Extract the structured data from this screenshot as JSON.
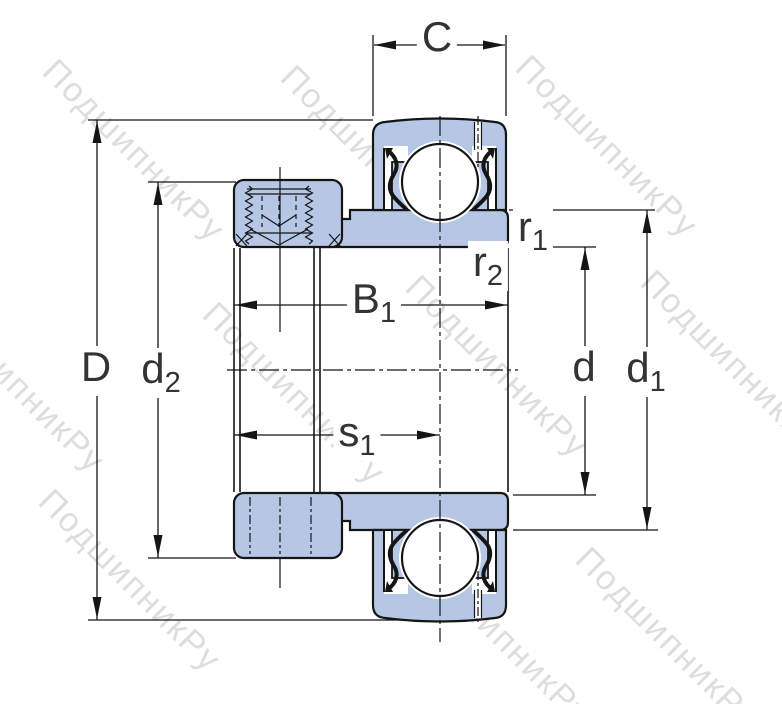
{
  "drawing": {
    "type": "bearing-cross-section",
    "description": "Insert ball bearing (Y-bearing) with eccentric locking collar, dimensional drawing"
  },
  "watermark": {
    "text": "ПодшипникРу",
    "color": "#c8c8c8"
  },
  "colors": {
    "part_fill": "#b6c7e6",
    "line": "#151515",
    "label": "#333333"
  },
  "labels": {
    "C": {
      "main": "C",
      "sub": ""
    },
    "D": {
      "main": "D",
      "sub": ""
    },
    "d2": {
      "main": "d",
      "sub": "2"
    },
    "B1": {
      "main": "B",
      "sub": "1"
    },
    "s1": {
      "main": "s",
      "sub": "1"
    },
    "r1": {
      "main": "r",
      "sub": "1"
    },
    "r2": {
      "main": "r",
      "sub": "2"
    },
    "d": {
      "main": "d",
      "sub": ""
    },
    "d1": {
      "main": "d",
      "sub": "1"
    }
  }
}
